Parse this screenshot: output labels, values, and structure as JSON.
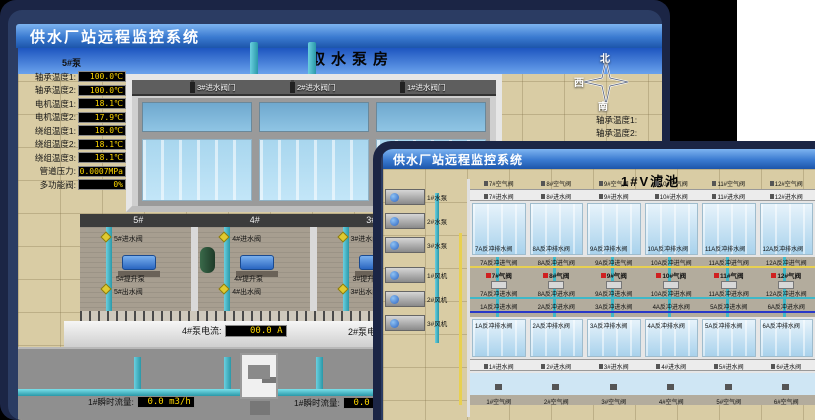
{
  "colors": {
    "accent_blue": "#2a62b8",
    "lcd_text": "#ffd800",
    "pipe_teal": "#3fb8c8",
    "valve_yellow": "#dfca30",
    "alarm_red": "#d02020"
  },
  "back_window": {
    "title": "供水厂站远程监控系统",
    "scene_title": "取水泵房",
    "pump_group_label": "5#泵",
    "compass": {
      "north": "北",
      "west": "西",
      "south": "南"
    },
    "metrics": [
      {
        "label": "轴承温度1:",
        "value": "100.0℃"
      },
      {
        "label": "轴承温度2:",
        "value": "100.0℃"
      },
      {
        "label": "电机温度1:",
        "value": "18.1℃"
      },
      {
        "label": "电机温度2:",
        "value": "17.9℃"
      },
      {
        "label": "绕组温度1:",
        "value": "18.0℃"
      },
      {
        "label": "绕组温度2:",
        "value": "18.1℃"
      },
      {
        "label": "绕组温度3:",
        "value": "18.1℃"
      },
      {
        "label": "管道压力:",
        "value": "0.0007MPa"
      },
      {
        "label": "多功能阀:",
        "value": "0%"
      }
    ],
    "right_edge_labels": [
      "轴承温度1:",
      "轴承温度2:"
    ],
    "inlet_gate_valves": [
      "3#进水阀门",
      "2#进水阀门",
      "1#进水阀门"
    ],
    "bays": [
      {
        "id": "5#",
        "inlet": "5#进水阀",
        "pump": "5#提升泵",
        "outlet": "5#出水阀"
      },
      {
        "id": "4#",
        "inlet": "4#进水阀",
        "pump": "4#提升泵",
        "outlet": "4#出水阀"
      },
      {
        "id": "3#",
        "inlet": "3#进水阀",
        "pump": "3#提升泵",
        "outlet": "3#出水阀"
      },
      {
        "id": "2#",
        "inlet": "2#进水阀",
        "pump": "2#提升泵",
        "outlet": "2#出水阀"
      }
    ],
    "current_meters": [
      {
        "label": "4#泵电流:",
        "value": "00.0 A"
      },
      {
        "label": "2#泵电流:",
        "value": ""
      }
    ],
    "flow_meters": [
      {
        "label": "1#瞬时流量:",
        "value": "0.0 m3/h"
      },
      {
        "label": "1#瞬时流量:",
        "value": "0.0 m3/h"
      }
    ]
  },
  "front_window": {
    "title": "供水厂站远程监控系统",
    "scene_title": "1#V滤池",
    "equipment": [
      {
        "label": "1#水泵"
      },
      {
        "label": "2#水泵"
      },
      {
        "label": "3#水泵"
      },
      {
        "label": "1#风机"
      },
      {
        "label": "2#风机"
      },
      {
        "label": "3#风机"
      }
    ],
    "top_cells": [
      {
        "air": "7#空气阀",
        "inlet": "7#进水阀",
        "drain": "7A反冲排水阀",
        "backwash_air": "7A反冲进气阀",
        "gas": "7#气阀",
        "backwash_water": "7A反冲进水阀"
      },
      {
        "air": "8#空气阀",
        "inlet": "8#进水阀",
        "drain": "8A反冲排水阀",
        "backwash_air": "8A反冲进气阀",
        "gas": "8#气阀",
        "backwash_water": "8A反冲进水阀"
      },
      {
        "air": "9#空气阀",
        "inlet": "9#进水阀",
        "drain": "9A反冲排水阀",
        "backwash_air": "9A反冲进气阀",
        "gas": "9#气阀",
        "backwash_water": "9A反冲进水阀"
      },
      {
        "air": "10#空气阀",
        "inlet": "10#进水阀",
        "drain": "10A反冲排水阀",
        "backwash_air": "10A反冲进气阀",
        "gas": "10#气阀",
        "backwash_water": "10A反冲进水阀"
      },
      {
        "air": "11#空气阀",
        "inlet": "11#进水阀",
        "drain": "11A反冲排水阀",
        "backwash_air": "11A反冲进气阀",
        "gas": "11#气阀",
        "backwash_water": "11A反冲进水阀"
      },
      {
        "air": "12#空气阀",
        "inlet": "12#进水阀",
        "drain": "12A反冲排水阀",
        "backwash_air": "12A反冲进气阀",
        "gas": "12#气阀",
        "backwash_water": "12A反冲进水阀"
      }
    ],
    "bottom_cells": [
      {
        "air": "1#空气阀",
        "inlet": "1#进水阀",
        "drain": "1A反冲排水阀",
        "backwash_water": "1A反冲进水阀"
      },
      {
        "air": "2#空气阀",
        "inlet": "2#进水阀",
        "drain": "2A反冲排水阀",
        "backwash_water": "2A反冲进水阀"
      },
      {
        "air": "3#空气阀",
        "inlet": "3#进水阀",
        "drain": "3A反冲排水阀",
        "backwash_water": "3A反冲进水阀"
      },
      {
        "air": "4#空气阀",
        "inlet": "4#进水阀",
        "drain": "4A反冲排水阀",
        "backwash_water": "4A反冲进水阀"
      },
      {
        "air": "5#空气阀",
        "inlet": "5#进水阀",
        "drain": "5A反冲排水阀",
        "backwash_water": "5A反冲进水阀"
      },
      {
        "air": "6#空气阀",
        "inlet": "6#进水阀",
        "drain": "6A反冲排水阀",
        "backwash_water": "6A反冲进水阀"
      }
    ]
  }
}
